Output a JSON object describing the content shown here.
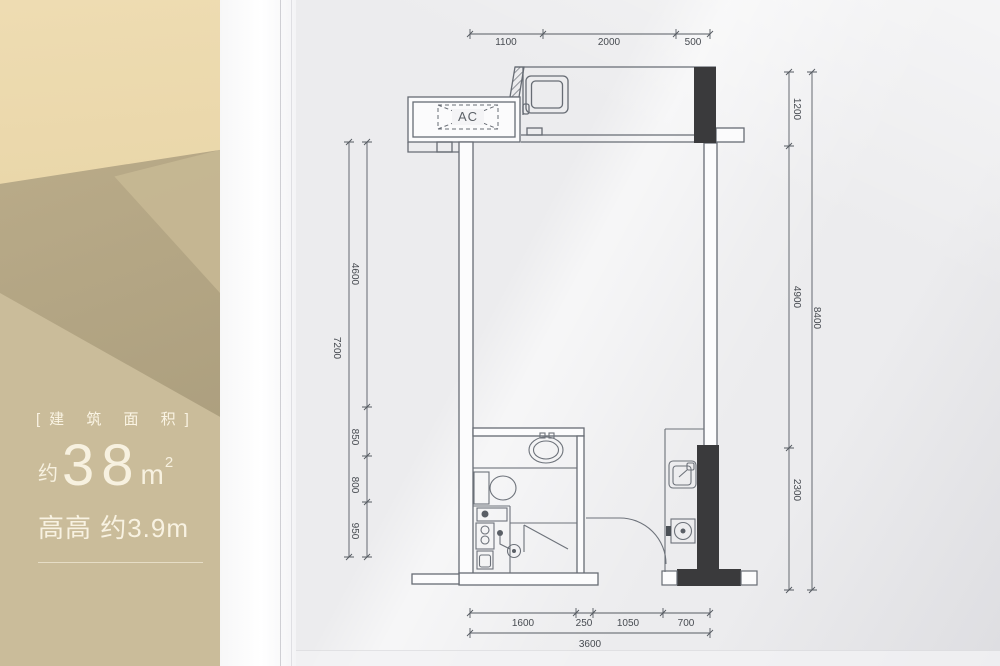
{
  "left_panel": {
    "area_title": "[建 筑 面 积]",
    "area_approx": "约",
    "area_value": "38",
    "area_unit": "m",
    "area_unit_exp": "2",
    "height_line": "高高 约3.9m"
  },
  "floor_plan": {
    "ac_label": "AC",
    "dimensions": {
      "top": [
        "1100",
        "2000",
        "500"
      ],
      "bottom": [
        "1600",
        "250",
        "1050",
        "700"
      ],
      "bottom_total": "3600",
      "left": [
        "4600",
        "850",
        "800",
        "950"
      ],
      "left_total": "7200",
      "right": [
        "1200",
        "4900",
        "2300"
      ],
      "right_total": "8400"
    }
  },
  "colors": {
    "panel_gold_light": "#eedcb2",
    "panel_gold_dark": "#a89b7b",
    "panel_text": "#f7f1e0",
    "paper": "#ececee",
    "plan_line": "#676c74",
    "black_fill": "#3a3a3c"
  }
}
